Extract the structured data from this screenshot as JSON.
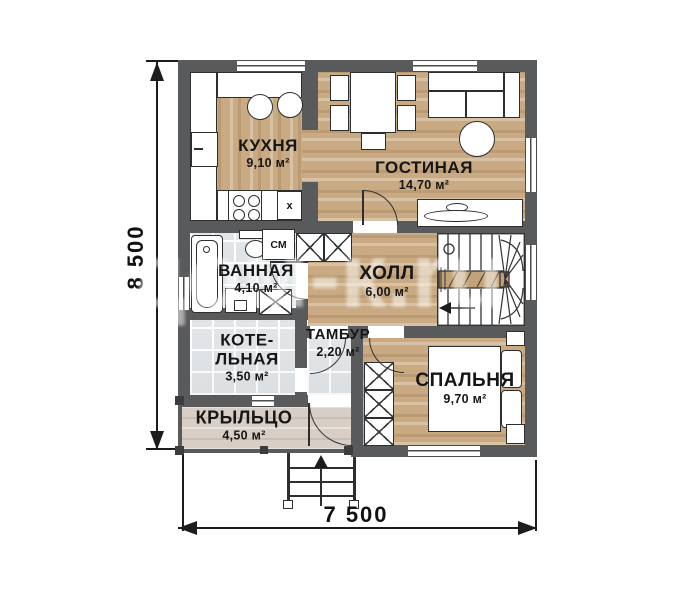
{
  "plan": {
    "rooms": [
      {
        "name": "КУХНЯ",
        "area": "9,10 м²"
      },
      {
        "name": "ГОСТИНАЯ",
        "area": "14,70 м²"
      },
      {
        "name": "ВАННАЯ",
        "area": "4,10 м²"
      },
      {
        "name": "ХОЛЛ",
        "area": "6,00 м²"
      },
      {
        "name": "КОТЕ-\nЛЬНАЯ",
        "area": "3,50 м²"
      },
      {
        "name": "ТАМБУР",
        "area": "2,20 м²"
      },
      {
        "name": "СПАЛЬНЯ",
        "area": "9,70 м²"
      },
      {
        "name": "КРЫЛЬЦО",
        "area": "4,50 м²"
      }
    ],
    "appliances": {
      "washing_machine": "СМ",
      "kitchen_cabinet": "x"
    },
    "dimensions": {
      "width": "7 500",
      "height": "8 500"
    },
    "watermark": "дом-к.ru"
  },
  "colors": {
    "wall": "#595a5c",
    "wood": "#c9aa82",
    "tile": "#e2e6e9",
    "porch": "#d9cec6"
  }
}
